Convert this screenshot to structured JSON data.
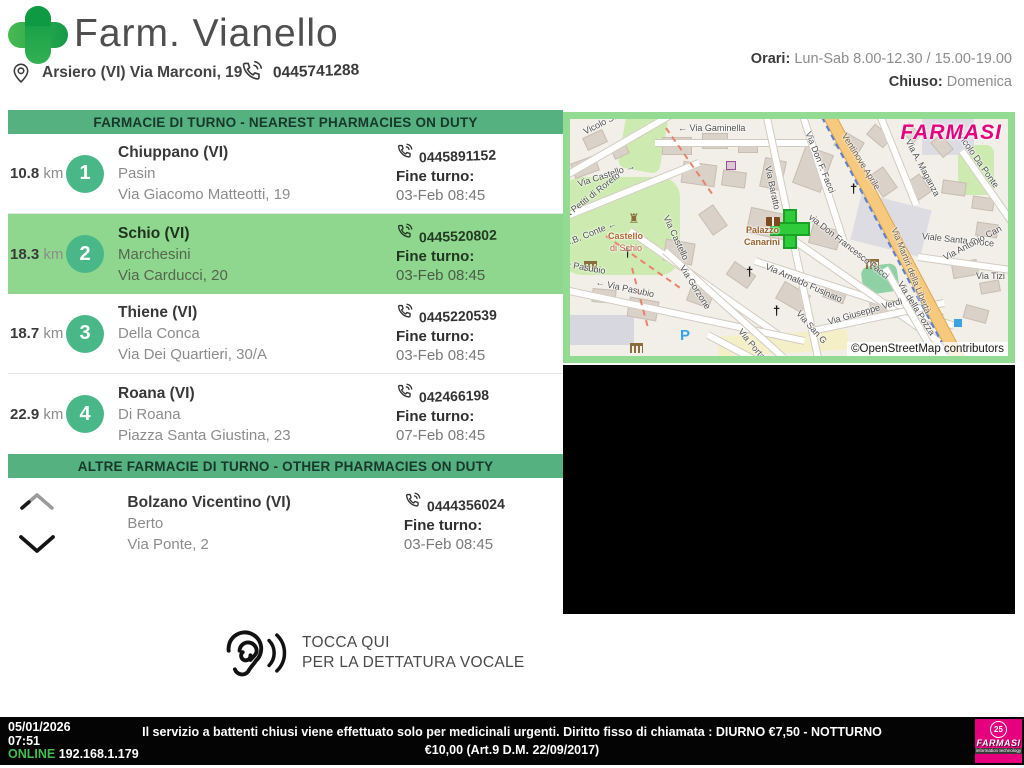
{
  "header": {
    "title": "Farm. Vianello",
    "address": "Arsiero (VI) Via Marconi, 19",
    "phone": "0445741288",
    "orari_label": "Orari:",
    "orari_value": " Lun-Sab 8.00-12.30 / 15.00-19.00",
    "chiuso_label": "Chiuso:",
    "chiuso_value": " Domenica"
  },
  "labels": {
    "fine_turno": "Fine turno:"
  },
  "nearest": {
    "banner": "FARMACIE DI TURNO - NEAREST PHARMACIES ON DUTY",
    "items": [
      {
        "distance": "10.8",
        "unit": " km",
        "rank": "1",
        "city": "Chiuppano (VI)",
        "name": "Pasin",
        "street": "Via Giacomo Matteotti, 19",
        "phone": "0445891152",
        "fine_value": "03-Feb 08:45"
      },
      {
        "distance": "18.3",
        "unit": " km",
        "rank": "2",
        "city": "Schio (VI)",
        "name": "Marchesini",
        "street": "Via Carducci, 20",
        "phone": "0445520802",
        "fine_value": "03-Feb 08:45"
      },
      {
        "distance": "18.7",
        "unit": " km",
        "rank": "3",
        "city": "Thiene (VI)",
        "name": "Della Conca",
        "street": "Via Dei Quartieri, 30/A",
        "phone": "0445220539",
        "fine_value": "03-Feb 08:45"
      },
      {
        "distance": "22.9",
        "unit": " km",
        "rank": "4",
        "city": "Roana (VI)",
        "name": "Di Roana",
        "street": "Piazza Santa Giustina, 23",
        "phone": "042466198",
        "fine_value": "07-Feb 08:45"
      }
    ]
  },
  "other": {
    "banner": "ALTRE FARMACIE DI TURNO - OTHER PHARMACIES ON DUTY",
    "items": [
      {
        "city": "Bolzano Vicentino (VI)",
        "name": "Berto",
        "street": "Via Ponte, 2",
        "phone": "0444356024",
        "fine_value": "03-Feb 08:45"
      }
    ]
  },
  "voice": {
    "line1": "TOCCA QUI",
    "line2": "PER LA DETTATURA VOCALE"
  },
  "map": {
    "watermark": "FARMASI",
    "attribution": "©OpenStreetMap contributors",
    "labels": [
      {
        "text": "Vicolo Santa Maria",
        "x": 14,
        "y": 8,
        "rot": -27
      },
      {
        "text": "← Via Gaminella",
        "x": 108,
        "y": 4,
        "rot": 0
      },
      {
        "text": "Via Castello →",
        "x": 8,
        "y": 60,
        "rot": -18
      },
      {
        "text": "Via Petiti di Roreto",
        "x": -10,
        "y": 96,
        "rot": -38
      },
      {
        "text": "G.B. Conte ←",
        "x": -6,
        "y": 120,
        "rot": -22
      },
      {
        "text": "Via Castello",
        "x": 96,
        "y": 92,
        "rot": 65
      },
      {
        "text": "Via Baratto",
        "x": 198,
        "y": 42,
        "rot": 78
      },
      {
        "text": "Via Don F. Facci",
        "x": 238,
        "y": 8,
        "rot": 68
      },
      {
        "text": "Ventinove Aprile",
        "x": 274,
        "y": 10,
        "rot": 58,
        "color": "#6a5b4a"
      },
      {
        "text": "Via A. Maganza",
        "x": 338,
        "y": 16,
        "rot": 62
      },
      {
        "text": "Vicolo Da Ponte",
        "x": 390,
        "y": 10,
        "rot": 55
      },
      {
        "text": "Viale Santa Croce",
        "x": 352,
        "y": 112,
        "rot": 6
      },
      {
        "text": "Via Antonio Can",
        "x": 374,
        "y": 134,
        "rot": -28
      },
      {
        "text": "Via Tizi",
        "x": 406,
        "y": 152,
        "rot": 0
      },
      {
        "text": "Via Martiri della Libertà",
        "x": 324,
        "y": 104,
        "rot": 68,
        "color": "#6a5b4a"
      },
      {
        "text": "via Don Francesco Facci",
        "x": 240,
        "y": 92,
        "rot": 38
      },
      {
        "text": "Palazzo",
        "x": 176,
        "y": 106,
        "rot": 0,
        "color": "#96622d",
        "bold": true
      },
      {
        "text": "Canarini",
        "x": 174,
        "y": 118,
        "rot": 0,
        "color": "#96622d",
        "bold": true
      },
      {
        "text": "a Pasubio",
        "x": -4,
        "y": 140,
        "rot": 10
      },
      {
        "text": "← Via Pasubio",
        "x": 26,
        "y": 158,
        "rot": 12
      },
      {
        "text": "Via Gorzone",
        "x": 112,
        "y": 142,
        "rot": 58
      },
      {
        "text": "Via Arnaldo Fusinato",
        "x": 196,
        "y": 142,
        "rot": 24
      },
      {
        "text": "Via San G",
        "x": 228,
        "y": 188,
        "rot": 48
      },
      {
        "text": "Via Giuseppe Verdi →",
        "x": 258,
        "y": 198,
        "rot": -16
      },
      {
        "text": "Via della Pozza",
        "x": 330,
        "y": 158,
        "rot": 58
      },
      {
        "text": "Via Porta di",
        "x": 170,
        "y": 206,
        "rot": 50
      },
      {
        "text": "Castello",
        "x": 38,
        "y": 112,
        "rot": 0,
        "color": "#b0652f",
        "bold": true
      },
      {
        "text": "di Schio",
        "x": 40,
        "y": 124,
        "rot": 0,
        "color": "#c05a4a"
      }
    ]
  },
  "footer": {
    "date": "05/01/2026",
    "time": "07:51",
    "online_label": "ONLINE",
    "ip": " 192.168.1.179",
    "notice_line1": "Il servizio a battenti chiusi viene effettuato solo per medicinali urgenti. Diritto fisso di chiamata : DIURNO €7,50 - NOTTURNO",
    "notice_line2": "€10,00 (Art.9 D.M. 22/09/2017)",
    "logo_badge": "25",
    "logo_text": "FARMASI",
    "logo_sub": "information technology"
  }
}
